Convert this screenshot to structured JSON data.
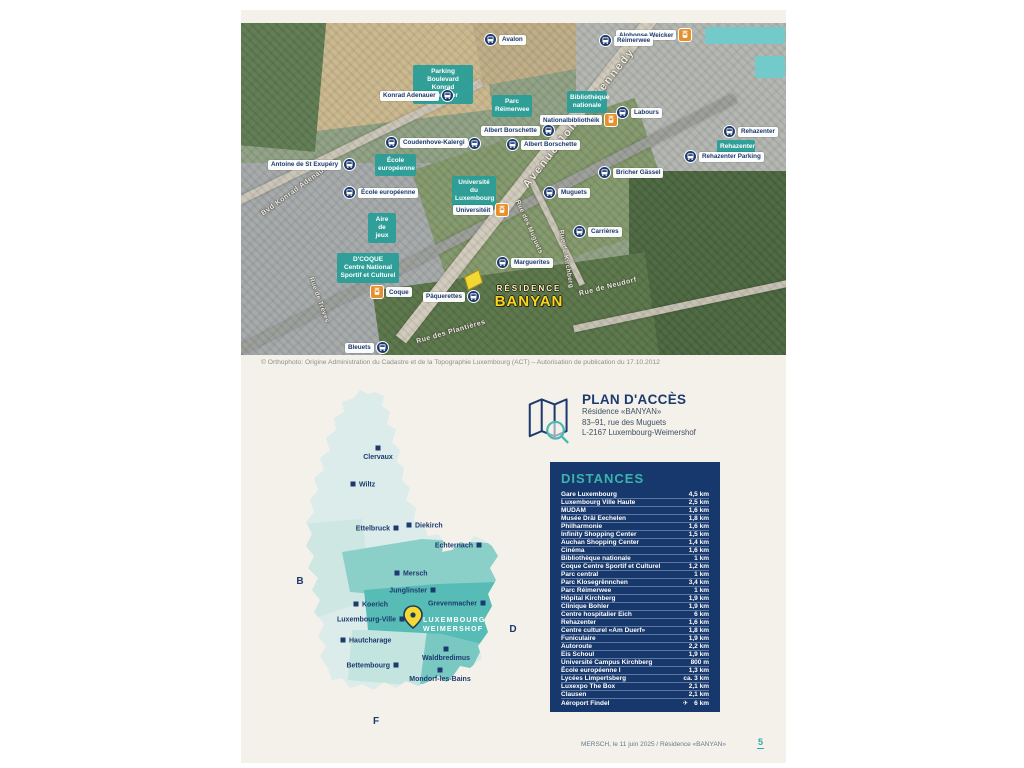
{
  "aerial_map": {
    "caption": "© Orthophoto: Origine Administration du Cadastre et de la Topographie Luxembourg (ACT) – Autorisation de publication du 17.10.2012",
    "residence": {
      "line1": "RÉSIDENCE",
      "line2": "BANYAN"
    },
    "stops": [
      {
        "label": "Avalon",
        "type": "bus",
        "side": "right",
        "x": 243,
        "y": 10
      },
      {
        "label": "Alphonse Weicker",
        "type": "tram",
        "side": "left",
        "x": 375,
        "y": 5
      },
      {
        "label": "Réimerwee",
        "type": "bus",
        "side": "right",
        "x": 358,
        "y": 11
      },
      {
        "label": "Konrad Adenauer",
        "type": "bus",
        "side": "left",
        "x": 139,
        "y": 66
      },
      {
        "label": "Nationalbibliothéik",
        "type": "tram",
        "side": "left",
        "x": 299,
        "y": 90
      },
      {
        "label": "Labours",
        "type": "bus",
        "side": "right",
        "x": 375,
        "y": 83
      },
      {
        "label": "Albert Borschette",
        "type": "bus",
        "side": "left",
        "x": 240,
        "y": 101
      },
      {
        "label": "Albert Borschette",
        "type": "bus",
        "side": "right",
        "x": 265,
        "y": 115
      },
      {
        "label": "Rehazenter",
        "type": "bus",
        "side": "right",
        "x": 482,
        "y": 102
      },
      {
        "label": "Rehazenter Parking",
        "type": "bus",
        "side": "right",
        "x": 443,
        "y": 127
      },
      {
        "label": "Coudenhove-Kalergi",
        "type": "bus",
        "side": "right",
        "x": 144,
        "y": 113
      },
      {
        "label": "",
        "type": "bus",
        "side": "right",
        "x": 227,
        "y": 114
      },
      {
        "label": "Antoine de St Exupéry",
        "type": "bus",
        "side": "left",
        "x": 27,
        "y": 135
      },
      {
        "label": "École européenne",
        "type": "bus",
        "side": "right",
        "x": 102,
        "y": 163
      },
      {
        "label": "Bricher Gässel",
        "type": "bus",
        "side": "right",
        "x": 357,
        "y": 143
      },
      {
        "label": "Universitéit",
        "type": "tram",
        "side": "left",
        "x": 212,
        "y": 180
      },
      {
        "label": "Muguets",
        "type": "bus",
        "side": "right",
        "x": 302,
        "y": 163
      },
      {
        "label": "Carrières",
        "type": "bus",
        "side": "right",
        "x": 332,
        "y": 202
      },
      {
        "label": "Marguerites",
        "type": "bus",
        "side": "right",
        "x": 255,
        "y": 233
      },
      {
        "label": "Coque",
        "type": "tram",
        "side": "right",
        "x": 129,
        "y": 262
      },
      {
        "label": "Pâquerettes",
        "type": "bus",
        "side": "left",
        "x": 182,
        "y": 267
      },
      {
        "label": "Bleuets",
        "type": "bus",
        "side": "left",
        "x": 104,
        "y": 318
      }
    ],
    "pois": [
      {
        "lines": [
          "Parking Boulevard",
          "Konrad Adenauer"
        ],
        "x": 172,
        "y": 42,
        "w": 60
      },
      {
        "lines": [
          "Parc",
          "Réimerwee"
        ],
        "x": 251,
        "y": 72,
        "w": 40
      },
      {
        "lines": [
          "Bibliothèque",
          "nationale"
        ],
        "x": 326,
        "y": 68,
        "w": 40
      },
      {
        "lines": [
          "Rehazenter"
        ],
        "x": 476,
        "y": 117,
        "w": 38
      },
      {
        "lines": [
          "École",
          "européenne"
        ],
        "x": 134,
        "y": 131,
        "w": 41
      },
      {
        "lines": [
          "Université du",
          "Luxembourg"
        ],
        "x": 211,
        "y": 153,
        "w": 44
      },
      {
        "lines": [
          "Aire de",
          "jeux"
        ],
        "x": 127,
        "y": 190,
        "w": 28
      },
      {
        "lines": [
          "D'COQUE",
          "Centre National",
          "Sportif et Culturel"
        ],
        "x": 96,
        "y": 230,
        "w": 62
      }
    ],
    "streets": [
      {
        "name": "Avenue John F. Kennedy",
        "x": 338,
        "y": 95,
        "rot": -52,
        "size": 11,
        "spacing": 2
      },
      {
        "name": "Bvd Konrad Adenauer",
        "x": 55,
        "y": 167,
        "rot": -36,
        "size": 7,
        "spacing": 0.5
      },
      {
        "name": "Rue de Trèves",
        "x": 78,
        "y": 277,
        "rot": 70,
        "size": 6.5,
        "spacing": 0.3
      },
      {
        "name": "Rue des Muguets",
        "x": 288,
        "y": 204,
        "rot": 66,
        "size": 6.5,
        "spacing": 0.3
      },
      {
        "name": "Rue de Kirchberg",
        "x": 325,
        "y": 236,
        "rot": 80,
        "size": 6.5,
        "spacing": 0.3
      },
      {
        "name": "Rue de Neudorf",
        "x": 367,
        "y": 264,
        "rot": -14,
        "size": 7,
        "spacing": 0.5
      },
      {
        "name": "Rue des Plantières",
        "x": 210,
        "y": 309,
        "rot": -16,
        "size": 7,
        "spacing": 0.5
      }
    ]
  },
  "country_map": {
    "cities": [
      {
        "name": "Clervaux",
        "sx": 86,
        "sy": 64,
        "placement": "below"
      },
      {
        "name": "Wiltz",
        "sx": 61,
        "sy": 100,
        "placement": "right"
      },
      {
        "name": "Ettelbruck",
        "sx": 104,
        "sy": 144,
        "placement": "left"
      },
      {
        "name": "Diekirch",
        "sx": 117,
        "sy": 141,
        "placement": "right"
      },
      {
        "name": "Echternach",
        "sx": 187,
        "sy": 161,
        "placement": "left"
      },
      {
        "name": "Mersch",
        "sx": 105,
        "sy": 189,
        "placement": "right"
      },
      {
        "name": "Junglinster",
        "sx": 141,
        "sy": 206,
        "placement": "left"
      },
      {
        "name": "Grevenmacher",
        "sx": 191,
        "sy": 219,
        "placement": "left"
      },
      {
        "name": "Koerich",
        "sx": 64,
        "sy": 220,
        "placement": "right"
      },
      {
        "name": "Luxembourg-Ville",
        "sx": 110,
        "sy": 235,
        "placement": "left"
      },
      {
        "name": "Hautcharage",
        "sx": 51,
        "sy": 256,
        "placement": "right"
      },
      {
        "name": "Bettembourg",
        "sx": 104,
        "sy": 281,
        "placement": "left"
      },
      {
        "name": "Waldbredimus",
        "sx": 154,
        "sy": 265,
        "placement": "below"
      },
      {
        "name": "Mondorf-les-Bains",
        "sx": 148,
        "sy": 286,
        "placement": "below"
      }
    ],
    "neighbors": [
      {
        "label": "B",
        "sx": 8,
        "sy": 200
      },
      {
        "label": "D",
        "sx": 221,
        "sy": 248
      },
      {
        "label": "F",
        "sx": 84,
        "sy": 340
      }
    ],
    "highlight": {
      "lines": [
        "LUXEMBOURG",
        "WEIMERSHOF"
      ],
      "sx": 131,
      "sy": 238
    }
  },
  "access": {
    "title": "PLAN D'ACCÈS",
    "lines": [
      "Résidence «BANYAN»",
      "83–91, rue des Muguets",
      "L-2167 Luxembourg-Weimershof"
    ]
  },
  "distances": {
    "title": "DISTANCES",
    "rows": [
      {
        "label": "Gare Luxembourg",
        "value": "4,5 km"
      },
      {
        "label": "Luxembourg Ville Haute",
        "value": "2,5 km"
      },
      {
        "label": "MUDAM",
        "value": "1,6 km"
      },
      {
        "label": "Musée Dräi Eechelen",
        "value": "1,8 km"
      },
      {
        "label": "Philharmonie",
        "value": "1,6 km"
      },
      {
        "label": "Infinity Shopping Center",
        "value": "1,5 km"
      },
      {
        "label": "Auchan Shopping Center",
        "value": "1,4 km"
      },
      {
        "label": "Cinéma",
        "value": "1,6 km"
      },
      {
        "label": "Bibliothèque nationale",
        "value": "1 km"
      },
      {
        "label": "Coque Centre Sportif et Culturel",
        "value": "1,2 km"
      },
      {
        "label": "Parc central",
        "value": "1 km"
      },
      {
        "label": "Parc Klosegrënnchen",
        "value": "3,4 km"
      },
      {
        "label": "Parc Réimerwee",
        "value": "1 km"
      },
      {
        "label": "Hôpital Kirchberg",
        "value": "1,9 km"
      },
      {
        "label": "Clinique Bohler",
        "value": "1,9 km"
      },
      {
        "label": "Centre hospitalier Eich",
        "value": "6 km"
      },
      {
        "label": "Rehazenter",
        "value": "1,6 km"
      },
      {
        "label": "Centre culturel «Am Duerf»",
        "value": "1,8 km"
      },
      {
        "label": "Funiculaire",
        "value": "1,9 km"
      },
      {
        "label": "Autoroute",
        "value": "2,2 km"
      },
      {
        "label": "Eis Schoul",
        "value": "1,9 km"
      },
      {
        "label": "Université Campus Kirchberg",
        "value": "800 m"
      },
      {
        "label": "École européenne I",
        "value": "1,3 km"
      },
      {
        "label": "Lycées Limpertsberg",
        "value": "ca. 3 km"
      },
      {
        "label": "Luxexpo The Box",
        "value": "2,1 km"
      },
      {
        "label": "Clausen",
        "value": "2,1 km"
      },
      {
        "label": "Aéroport Findel",
        "value": "6 km",
        "icon": "plane-icon"
      }
    ]
  },
  "footer": {
    "text": "MERSCH, le 11 juin 2025  /  Résidence «BANYAN»",
    "page_number": "5"
  }
}
